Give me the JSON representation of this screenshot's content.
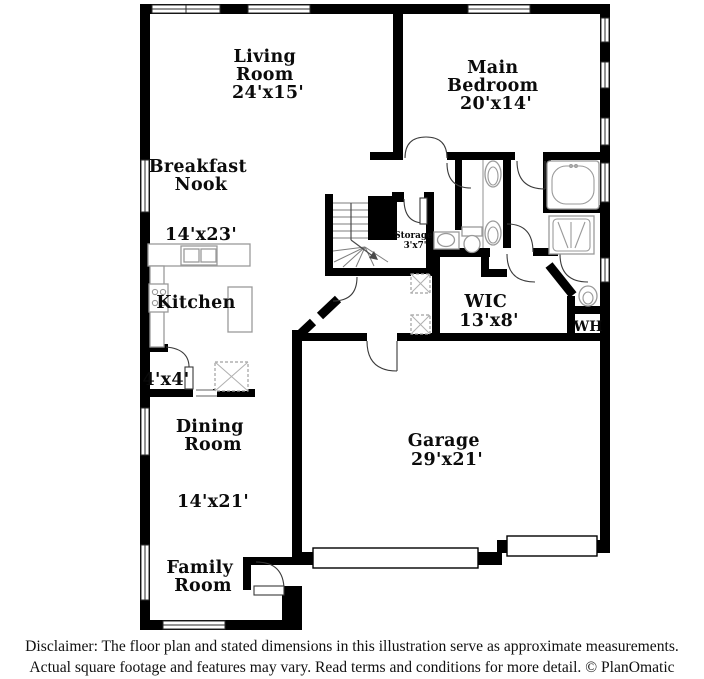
{
  "plan": {
    "rooms": {
      "living_room": {
        "lines": [
          "Living",
          "Room",
          "24'x15'"
        ]
      },
      "main_bedroom": {
        "lines": [
          "Main",
          "Bedroom",
          "20'x14'"
        ]
      },
      "breakfast_nook": {
        "lines": [
          "Breakfast",
          "Nook"
        ],
        "dims": "14'x23'"
      },
      "kitchen": {
        "label": "Kitchen"
      },
      "closet_4x4": {
        "label": "4'x4'"
      },
      "dining_room": {
        "lines": [
          "Dining",
          "Room"
        ],
        "dims": "14'x21'"
      },
      "family_room": {
        "lines": [
          "Family",
          "Room"
        ]
      },
      "garage": {
        "lines": [
          "Garage",
          "29'x21'"
        ]
      },
      "wic": {
        "lines": [
          "WIC",
          "13'x8'"
        ]
      },
      "storage": {
        "lines": [
          "Storage",
          "3'x7'"
        ]
      },
      "water_heater": {
        "label": "WH"
      }
    },
    "colors": {
      "wall": "#000000",
      "fixture": "#9a9a9a",
      "background": "#ffffff",
      "text": "#0b0b0b"
    }
  },
  "footer": {
    "line1": "Disclaimer: The floor plan and stated dimensions in this illustration serve as approximate measurements.",
    "line2": "Actual square footage and features may vary. Read terms and conditions for more detail. © PlanOmatic"
  }
}
